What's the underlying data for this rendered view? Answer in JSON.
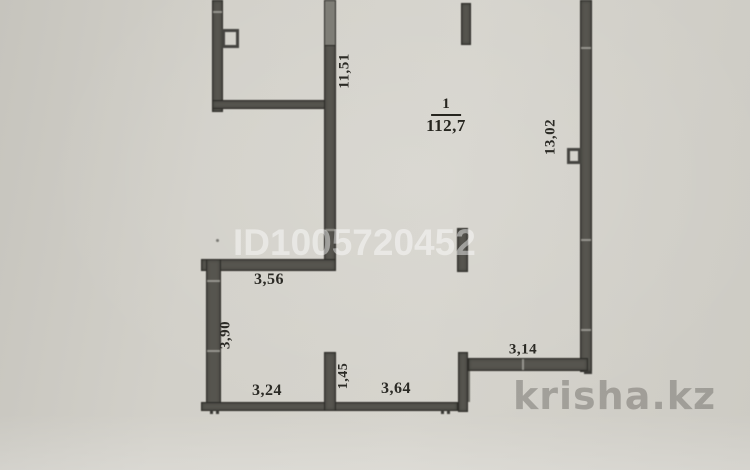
{
  "watermarks": {
    "listing_id": "ID1005720452",
    "site_logo": "krisha.kz"
  },
  "room_label": {
    "number": "1",
    "area": "112,7"
  },
  "dimensions": {
    "top_room_height": "11,51",
    "right_side_height": "13,02",
    "upper_width": "3,56",
    "left_lower_height": "3,90",
    "lower_left_width": "3,24",
    "lower_opening_height": "1,45",
    "lower_mid_width": "3,64",
    "lower_right_width": "3,14"
  },
  "colors": {
    "paper": "#d0cec7",
    "wall_fill": "#56554f",
    "wall_outline": "#2c2b27",
    "dimension_text": "#2b2a25",
    "id_watermark": "rgba(255,255,255,0.45)",
    "logo_watermark": "rgba(95,94,89,0.42)"
  }
}
